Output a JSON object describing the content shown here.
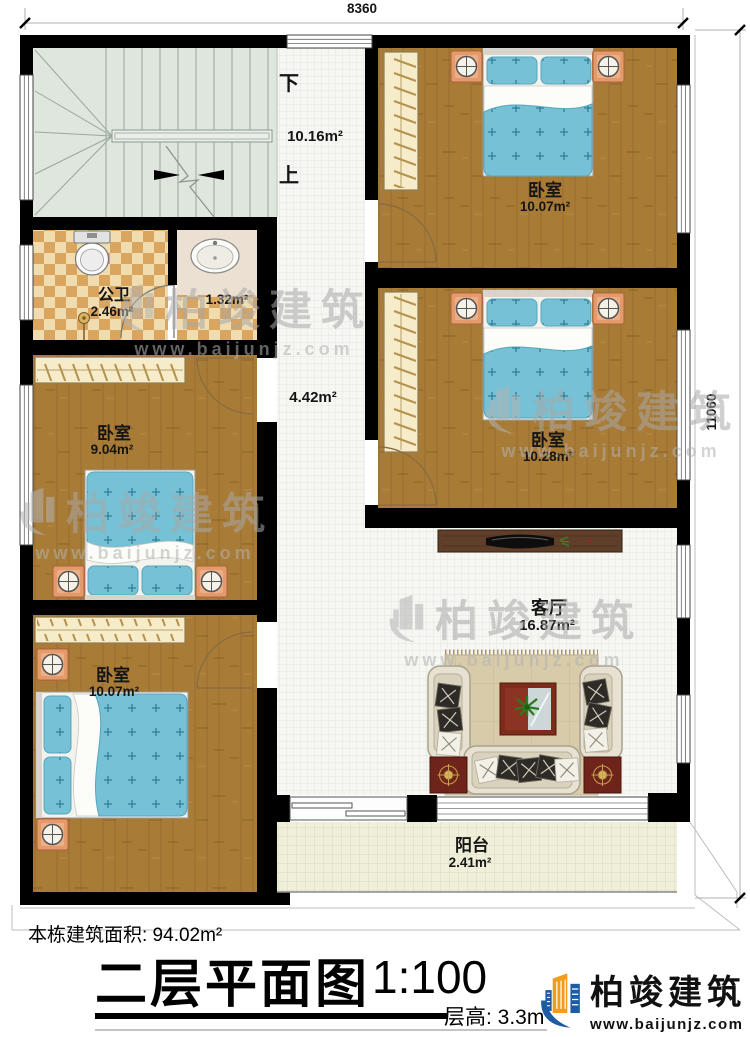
{
  "dimensions": {
    "width_top": "8360",
    "height_right": "11060"
  },
  "stairwell": {
    "down_label": "下",
    "up_label": "上",
    "area": "10.16m²"
  },
  "hallway": {
    "area": "4.42m²"
  },
  "rooms": {
    "bedroom_top_right": {
      "name": "卧室",
      "area": "10.07m²"
    },
    "bedroom_mid_right": {
      "name": "卧室",
      "area": "10.28m²"
    },
    "bathroom": {
      "name": "公卫",
      "area": "2.46m²"
    },
    "washroom": {
      "area": "1.32m²"
    },
    "bedroom_mid_left": {
      "name": "卧室",
      "area": "9.04m²"
    },
    "bedroom_bottom_left": {
      "name": "卧室",
      "area": "10.07m²"
    },
    "living_room": {
      "name": "客厅",
      "area": "16.87m²"
    },
    "balcony": {
      "name": "阳台",
      "area": "2.41m²"
    }
  },
  "title_block": {
    "building_area": "本栋建筑面积: 94.02m²",
    "plan_title": "二层平面图",
    "scale": "1:100",
    "floor_height": "层高: 3.3m"
  },
  "brand": {
    "name": "柏竣建筑",
    "url": "www.baijunjz.com"
  },
  "colors": {
    "wall": "#000000",
    "wood_floor": "#a87c36",
    "bed_blue": "#76c1d5",
    "stair_green": "#dfe6dd",
    "checker_tan": "#d9a55f",
    "brand_blue": "#1d5ca5",
    "brand_orange": "#f29b1d"
  }
}
